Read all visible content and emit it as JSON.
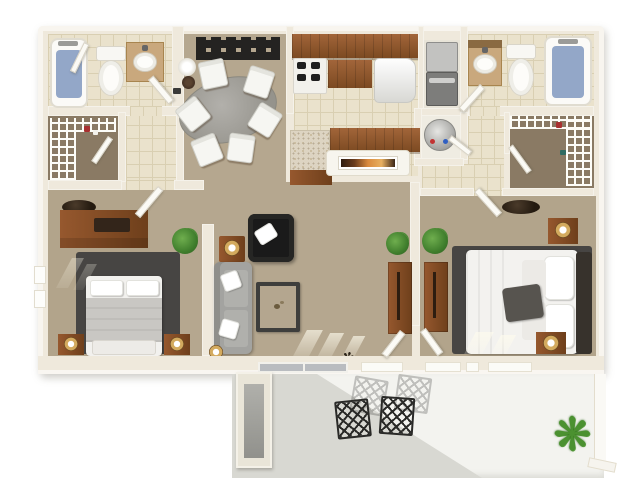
{
  "meta": {
    "type": "3d-floor-plan-rendering",
    "subject": "Two-bedroom, two-bathroom apartment with balcony patio, viewed top-down",
    "visible_text": "(none — the image contains no readable text)"
  },
  "palette": {
    "background": "#ffffff",
    "wall": "#efe9dc",
    "carpet": "#b5a78f",
    "closet_carpet": "#8a7a64",
    "tile": "#eae2cc",
    "wood": "#8a542c",
    "rug_dark_gray": "#474543",
    "sofa_gray": "#a3a3a0",
    "black_chair": "#1a1a1a",
    "bath_mat_blue": "#93a7c8",
    "patio_floor": "#f3f3ef",
    "patio_shadow": "#d8d8d2",
    "plant_green": "#3f7d2c",
    "lamp_gold": "#d3aa5e",
    "art_sunset": [
      "#2e1c10",
      "#d98a3e",
      "#e8b060"
    ]
  },
  "icons": {
    "patio_plant": "❋",
    "floor_twigs": "✻"
  },
  "rooms": [
    {
      "id": "bathroom-1",
      "position": "top-left",
      "contents": [
        "bathtub with blue mat",
        "toilet",
        "vanity with sink",
        "door"
      ]
    },
    {
      "id": "walk-in-closet-1",
      "position": "left",
      "contents": [
        "white wire shelving",
        "hanging clothes"
      ]
    },
    {
      "id": "dining-room",
      "position": "top-center-left",
      "contents": [
        "oval gray table",
        "six white chairs",
        "floor lamp",
        "black wall shelf art"
      ]
    },
    {
      "id": "kitchen",
      "position": "top-center",
      "contents": [
        "upper wood cabinets",
        "range with burners",
        "base cabinets",
        "refrigerator",
        "granite counter",
        "breakfast bar with framed sunset art"
      ]
    },
    {
      "id": "laundry-closet",
      "position": "right-of-kitchen",
      "contents": [
        "stacked washer-dryer"
      ]
    },
    {
      "id": "water-heater-closet",
      "position": "right-of-kitchen-lower",
      "contents": [
        "round water heater with red and blue valves",
        "door"
      ]
    },
    {
      "id": "bathroom-2",
      "position": "top-right",
      "contents": [
        "vanity with sink",
        "toilet",
        "bathtub with blue mat",
        "door"
      ]
    },
    {
      "id": "walk-in-closet-2",
      "position": "right",
      "contents": [
        "white wire shelving",
        "hanging clothes",
        "door"
      ]
    },
    {
      "id": "bedroom-1",
      "position": "bottom-left",
      "contents": [
        "wood dresser with dark tray",
        "dark oval wall decor",
        "dark gray area rug",
        "bed with gray blanket and white pillows",
        "two wood nightstands with gold lamps",
        "potted plant",
        "windows on left wall"
      ]
    },
    {
      "id": "living-room",
      "position": "center",
      "contents": [
        "black armchair with white pillow",
        "wood side table with gold lamp",
        "gray sofa with two white pillows",
        "framed coffee table",
        "small floor lamp",
        "wood bookshelf",
        "two potted plants",
        "twig floor decor",
        "sliding glass door to patio"
      ]
    },
    {
      "id": "bedroom-2",
      "position": "bottom-right",
      "contents": [
        "dark oval wall decor",
        "dark gray area rug",
        "white bed with dark gray accent pillow and dark headboard",
        "two wood nightstands with gold lamps",
        "wood bookshelf",
        "potted plant",
        "windows"
      ]
    },
    {
      "id": "patio",
      "position": "bottom",
      "contents": [
        "storage closet",
        "two dark lattice chairs",
        "two faint chair shadows",
        "spiky green plant",
        "diagonal building shadow"
      ]
    }
  ]
}
